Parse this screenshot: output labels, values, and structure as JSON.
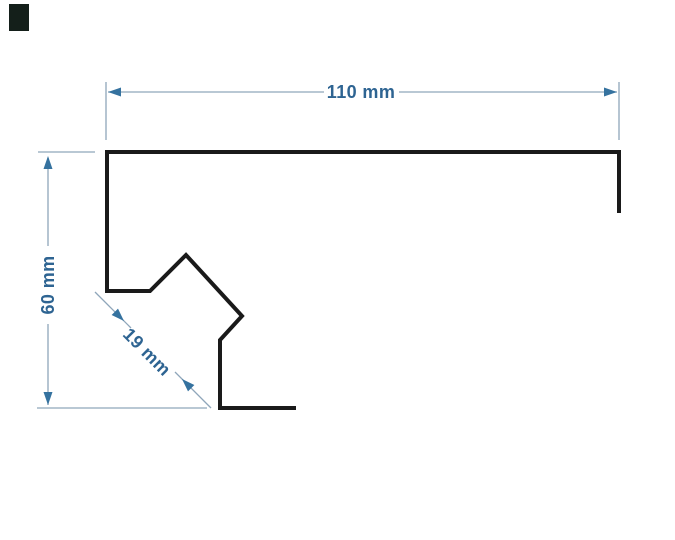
{
  "diagram": {
    "labels": {
      "width": "110 mm",
      "height": "60 mm",
      "hook": "19 mm"
    },
    "colors": {
      "background": "#ffffff",
      "profile": "#1a1a1a",
      "dimension_lines": "#8fa6ba",
      "arrows": "#35729f",
      "text": "#2e6492",
      "swatch": "#141f1a"
    },
    "canvas": {
      "width": 675,
      "height": 540
    },
    "swatch": {
      "x": 9,
      "y": 4,
      "width": 20,
      "height": 27
    },
    "profile": {
      "stroke_width": 4,
      "points": [
        [
          619,
          213
        ],
        [
          619,
          152
        ],
        [
          107,
          152
        ],
        [
          107,
          291
        ],
        [
          150,
          291
        ],
        [
          186,
          255
        ],
        [
          242,
          316
        ],
        [
          220,
          340
        ],
        [
          220,
          408
        ],
        [
          296,
          408
        ]
      ]
    },
    "dimension_lines": [
      {
        "name": "ext-line-110-left",
        "x1": 106,
        "y1": 82,
        "x2": 106,
        "y2": 140
      },
      {
        "name": "ext-line-110-right",
        "x1": 619,
        "y1": 82,
        "x2": 619,
        "y2": 140
      },
      {
        "name": "dim-line-110-a",
        "x1": 108,
        "y1": 92,
        "x2": 324,
        "y2": 92
      },
      {
        "name": "dim-line-110-b",
        "x1": 399,
        "y1": 92,
        "x2": 617,
        "y2": 92
      },
      {
        "name": "ext-line-60-top",
        "x1": 38,
        "y1": 152,
        "x2": 95,
        "y2": 152
      },
      {
        "name": "ext-line-60-bottom",
        "x1": 37,
        "y1": 408,
        "x2": 207,
        "y2": 408
      },
      {
        "name": "dim-line-60-a",
        "x1": 48,
        "y1": 158,
        "x2": 48,
        "y2": 246
      },
      {
        "name": "dim-line-60-b",
        "x1": 48,
        "y1": 324,
        "x2": 48,
        "y2": 405
      },
      {
        "name": "dim-line-19-a",
        "x1": 95,
        "y1": 292,
        "x2": 131,
        "y2": 328
      },
      {
        "name": "dim-line-19-b",
        "x1": 175,
        "y1": 372,
        "x2": 211,
        "y2": 408
      }
    ],
    "arrows": [
      {
        "name": "arrow-110-left",
        "tip": [
          108,
          92
        ],
        "dir": 180
      },
      {
        "name": "arrow-110-right",
        "tip": [
          617,
          92
        ],
        "dir": 0
      },
      {
        "name": "arrow-60-up",
        "tip": [
          48,
          156
        ],
        "dir": 270
      },
      {
        "name": "arrow-60-down",
        "tip": [
          48,
          405
        ],
        "dir": 90
      },
      {
        "name": "arrow-19-upper",
        "tip": [
          124,
          321
        ],
        "dir": 45
      },
      {
        "name": "arrow-19-lower",
        "tip": [
          182,
          379
        ],
        "dir": 225
      }
    ],
    "label_anchors": {
      "width": {
        "x": 361,
        "y": 92,
        "rot": 0
      },
      "height": {
        "x": 48,
        "y": 285,
        "rot": -90
      },
      "hook": {
        "x": 147,
        "y": 352,
        "rot": 45
      }
    }
  }
}
